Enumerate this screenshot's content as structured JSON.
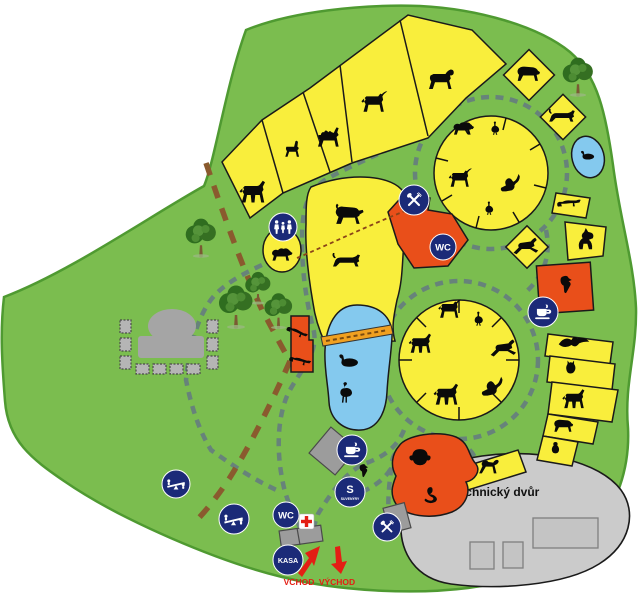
{
  "labels": {
    "technical_yard": "technický dvůr",
    "entrance": "VCHOD",
    "exit": "VÝCHOD",
    "ticket_office": "KASA",
    "wc": "WC",
    "souvenir_initial": "S",
    "souvenir_word": "SUVENÝRY"
  },
  "colors": {
    "park_green": "#7bbd4f",
    "park_edge": "#4f9a31",
    "enclosure_yellow": "#f9ee3c",
    "water_blue": "#84c9ee",
    "building_orange": "#e94f1a",
    "bridge_orange": "#f0a020",
    "visitor_path_gray": "#67837a",
    "service_path_brown": "#8a5a2e",
    "icon_navy": "#1b2a78",
    "building_gray": "#9c9c9c",
    "technical_yard_gray": "#cbcbcb",
    "accent_red": "#e41e14",
    "animal_black": "#0a0a0a"
  },
  "enclosures": [
    {
      "area": "paddock-strip",
      "animals": [
        "horse",
        "llama",
        "camel",
        "ibex",
        "mouflon"
      ]
    },
    {
      "area": "upper-circle-paddock",
      "animals": [
        "sheep",
        "ostrich",
        "goat",
        "kangaroo",
        "emu"
      ]
    },
    {
      "area": "bear-pen",
      "animals": [
        "bear"
      ]
    },
    {
      "area": "marten-pen",
      "animals": [
        "marten"
      ]
    },
    {
      "area": "duck-pond",
      "animals": [
        "duck"
      ]
    },
    {
      "area": "raccoon-pen",
      "animals": [
        "raccoon"
      ]
    },
    {
      "area": "wolf-pen",
      "animals": [
        "wolf"
      ]
    },
    {
      "area": "chamois-pen",
      "animals": [
        "chamois"
      ]
    },
    {
      "area": "parrot-house",
      "animals": [
        "parrot"
      ]
    },
    {
      "area": "bird-of-prey-row",
      "animals": [
        "eagle",
        "owl",
        "deer",
        "badger",
        "penguin"
      ]
    },
    {
      "area": "lower-circle-paddock",
      "animals": [
        "antelope",
        "emu",
        "gazelle",
        "kangaroo",
        "pony",
        "donkey"
      ]
    },
    {
      "area": "big-cat-enclosure",
      "animals": [
        "lion",
        "leopard"
      ]
    },
    {
      "area": "petting-paddock",
      "animals": [
        "sheep"
      ]
    },
    {
      "area": "otter-house",
      "animals": [
        "otter",
        "otter"
      ]
    },
    {
      "area": "waterfowl-pond",
      "animals": [
        "swan",
        "flamingo"
      ]
    },
    {
      "area": "monkey-island",
      "animals": [
        "chimpanzee",
        "snake"
      ]
    },
    {
      "area": "macaque-pen",
      "animals": [
        "macaque"
      ]
    }
  ],
  "facilities": [
    {
      "name": "restaurant-north",
      "icon": "crossed-cutlery"
    },
    {
      "name": "wc-north",
      "label": "WC"
    },
    {
      "name": "cafe-east",
      "icon": "coffee-cup"
    },
    {
      "name": "cafe-central",
      "icon": "coffee-cup"
    },
    {
      "name": "souvenir-shop",
      "label": "S SUVENÝRY"
    },
    {
      "name": "wc-entrance",
      "label": "WC"
    },
    {
      "name": "first-aid",
      "icon": "red-cross"
    },
    {
      "name": "ticket-office",
      "label": "KASA"
    },
    {
      "name": "restaurant-south",
      "icon": "crossed-cutlery"
    },
    {
      "name": "petting-zoo",
      "icon": "visitors"
    },
    {
      "name": "playground-west",
      "icon": "seesaw"
    },
    {
      "name": "playground-south",
      "icon": "seesaw"
    },
    {
      "name": "amphitheatre",
      "icon": "stage"
    },
    {
      "name": "technical-yard",
      "label": "technický dvůr"
    },
    {
      "name": "entrance",
      "label": "VCHOD"
    },
    {
      "name": "exit",
      "label": "VÝCHOD"
    }
  ]
}
